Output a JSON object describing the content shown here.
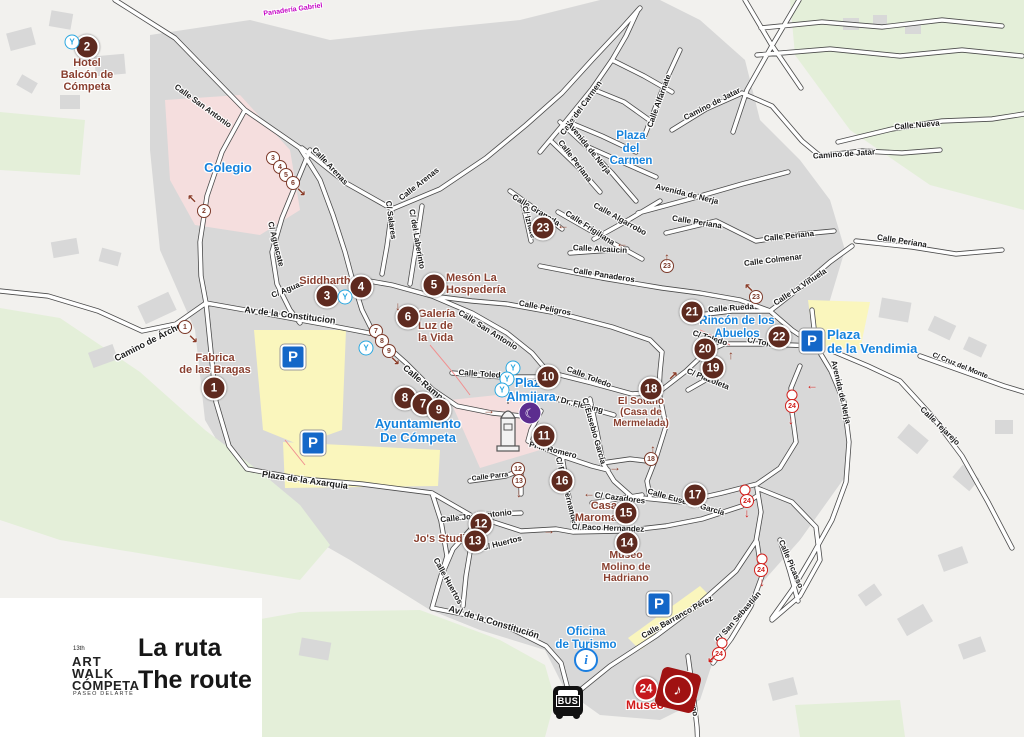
{
  "legend": {
    "edition": "13th",
    "logo_line1": "ART",
    "logo_line2": "WALK",
    "logo_line3": "CÓMPETA",
    "logo_subtitle": "PASEO DELARTE",
    "title_es": "La ruta",
    "title_en": "The route"
  },
  "colors": {
    "marker_brown": "#5e2a1f",
    "marker_red": "#c6181d",
    "route_brown": "#7c3a2a",
    "route_red": "#d1201c",
    "poi_maroon": "#8a4030",
    "poi_blue": "#1583dd",
    "parking_blue": "#1467c8",
    "museum_red": "#a01212",
    "moon_purple": "#5c2d8f",
    "parking_yellow": "#faf6bd",
    "school_pink": "#f5dede",
    "park_green": "#e4efd9",
    "building_gray": "#d8d8d8"
  },
  "icons": {
    "parking_glyph": "P",
    "info_glyph": "i",
    "bus_label": "BUS",
    "moon_glyph": "☾",
    "music_glyph": "♪",
    "fountain_glyph": "Y"
  },
  "markers": [
    {
      "n": "1",
      "x": 214,
      "y": 388
    },
    {
      "n": "2",
      "x": 87,
      "y": 47
    },
    {
      "n": "3",
      "x": 327,
      "y": 296
    },
    {
      "n": "4",
      "x": 361,
      "y": 287
    },
    {
      "n": "5",
      "x": 434,
      "y": 285
    },
    {
      "n": "6",
      "x": 408,
      "y": 317
    },
    {
      "n": "8",
      "x": 405,
      "y": 398
    },
    {
      "n": "7",
      "x": 423,
      "y": 404
    },
    {
      "n": "9",
      "x": 439,
      "y": 410
    },
    {
      "n": "10",
      "x": 548,
      "y": 377
    },
    {
      "n": "11",
      "x": 544,
      "y": 436
    },
    {
      "n": "12",
      "x": 481,
      "y": 524
    },
    {
      "n": "13",
      "x": 475,
      "y": 541
    },
    {
      "n": "14",
      "x": 627,
      "y": 543
    },
    {
      "n": "15",
      "x": 626,
      "y": 513
    },
    {
      "n": "16",
      "x": 562,
      "y": 481
    },
    {
      "n": "17",
      "x": 695,
      "y": 495
    },
    {
      "n": "18",
      "x": 651,
      "y": 389
    },
    {
      "n": "19",
      "x": 713,
      "y": 368
    },
    {
      "n": "20",
      "x": 705,
      "y": 349
    },
    {
      "n": "21",
      "x": 692,
      "y": 312
    },
    {
      "n": "22",
      "x": 779,
      "y": 337
    },
    {
      "n": "23",
      "x": 543,
      "y": 228
    },
    {
      "n": "24",
      "x": 646,
      "y": 689,
      "red": true
    }
  ],
  "pois": [
    {
      "lines": [
        "Hotel",
        "Balcón de",
        "Cómpeta"
      ],
      "x": 87,
      "y": 57,
      "fs": 11
    },
    {
      "lines": [
        "Fabrica",
        "de las Bragas"
      ],
      "x": 215,
      "y": 352,
      "fs": 11
    },
    {
      "lines": [
        "Siddhartha"
      ],
      "x": 328,
      "y": 275,
      "fs": 11
    },
    {
      "lines": [
        "Mesón La",
        "Hospedería"
      ],
      "x": 446,
      "y": 272,
      "fs": 11,
      "align": "left"
    },
    {
      "lines": [
        "Galería",
        "Luz de",
        "la Vida"
      ],
      "x": 418,
      "y": 308,
      "fs": 11,
      "align": "left"
    },
    {
      "lines": [
        "El Sotano",
        "(Casa de",
        "Mermelada)"
      ],
      "x": 641,
      "y": 396,
      "fs": 10
    },
    {
      "lines": [
        "Casa",
        "Maroma"
      ],
      "x": 617,
      "y": 500,
      "fs": 11,
      "align": "right"
    },
    {
      "lines": [
        "Museo",
        "Molino de",
        "Hadriano"
      ],
      "x": 626,
      "y": 550,
      "fs": 10.5
    },
    {
      "lines": [
        "Jo's Studio"
      ],
      "x": 443,
      "y": 533,
      "fs": 11
    },
    {
      "lines": [
        "Museo"
      ],
      "x": 645,
      "y": 699,
      "fs": 12,
      "cls": "red"
    },
    {
      "lines": [
        "Colegio"
      ],
      "x": 228,
      "y": 161,
      "fs": 13,
      "cls": "blue"
    },
    {
      "lines": [
        "Plaza",
        "del",
        "Carmen"
      ],
      "x": 631,
      "y": 130,
      "fs": 11.5,
      "cls": "blue"
    },
    {
      "lines": [
        "Plaza",
        "Almijara"
      ],
      "x": 531,
      "y": 377,
      "fs": 12.5,
      "cls": "blue"
    },
    {
      "lines": [
        "Ayuntamiento",
        "De Cómpeta"
      ],
      "x": 418,
      "y": 417,
      "fs": 13,
      "cls": "blue"
    },
    {
      "lines": [
        "Rincón de los",
        "Abuelos"
      ],
      "x": 737,
      "y": 315,
      "fs": 11.5,
      "cls": "blue"
    },
    {
      "lines": [
        "Plaza",
        "de la Vendimia"
      ],
      "x": 827,
      "y": 328,
      "fs": 13,
      "cls": "blue",
      "align": "left"
    },
    {
      "lines": [
        "Oficina",
        "de Turismo"
      ],
      "x": 586,
      "y": 626,
      "fs": 11.5,
      "cls": "blue"
    }
  ],
  "streets": [
    {
      "t": "Calle San Antonio",
      "x": 203,
      "y": 106,
      "r": 36
    },
    {
      "t": "Calle Arenas",
      "x": 330,
      "y": 166,
      "r": 47
    },
    {
      "t": "Calle Arenas",
      "x": 419,
      "y": 184,
      "r": -38
    },
    {
      "t": "C/ Salares",
      "x": 391,
      "y": 220,
      "r": 82
    },
    {
      "t": "C/ del Laberinto",
      "x": 417,
      "y": 239,
      "r": 80
    },
    {
      "t": "C/ Aguacate",
      "x": 276,
      "y": 244,
      "r": 76
    },
    {
      "t": "C/ Aguacate",
      "x": 293,
      "y": 287,
      "r": -22
    },
    {
      "t": "Av de la Constitucion",
      "x": 290,
      "y": 315,
      "r": 7,
      "fs": 9
    },
    {
      "t": "Camino de Árchez",
      "x": 150,
      "y": 341,
      "r": -27,
      "fs": 9
    },
    {
      "t": "Plaza de la Axarquia",
      "x": 305,
      "y": 480,
      "r": 8,
      "fs": 9
    },
    {
      "t": "Calle Rampa",
      "x": 425,
      "y": 384,
      "r": 40,
      "fs": 9
    },
    {
      "t": "Calle San Antonio",
      "x": 488,
      "y": 330,
      "r": 32
    },
    {
      "t": "Calle Peligros",
      "x": 545,
      "y": 308,
      "r": 11
    },
    {
      "t": "Calle Panaderos",
      "x": 604,
      "y": 275,
      "r": 9
    },
    {
      "t": "Calle Alcaucin",
      "x": 600,
      "y": 249,
      "r": 3
    },
    {
      "t": "Calle Frigiliana",
      "x": 590,
      "y": 228,
      "r": 33
    },
    {
      "t": "Calle Granada",
      "x": 536,
      "y": 210,
      "r": 31
    },
    {
      "t": "C/ Iznate",
      "x": 529,
      "y": 222,
      "r": 74
    },
    {
      "t": "Calle Algarrobo",
      "x": 620,
      "y": 219,
      "r": 29
    },
    {
      "t": "Calle del Carmen",
      "x": 581,
      "y": 108,
      "r": -54
    },
    {
      "t": "Calle Alfarnate",
      "x": 659,
      "y": 101,
      "r": -70
    },
    {
      "t": "Camino de Jatar",
      "x": 712,
      "y": 104,
      "r": -27
    },
    {
      "t": "Avenida de Nerja",
      "x": 589,
      "y": 148,
      "r": 51
    },
    {
      "t": "Calle Periana",
      "x": 575,
      "y": 161,
      "r": 53
    },
    {
      "t": "Avenida de Nerja",
      "x": 687,
      "y": 194,
      "r": 14
    },
    {
      "t": "Calle Periana",
      "x": 697,
      "y": 222,
      "r": 9
    },
    {
      "t": "Calle Periana",
      "x": 789,
      "y": 236,
      "r": -6
    },
    {
      "t": "Calle Periana",
      "x": 902,
      "y": 241,
      "r": 9
    },
    {
      "t": "Calle Nueva",
      "x": 917,
      "y": 125,
      "r": -5
    },
    {
      "t": "Camino de Jatar",
      "x": 844,
      "y": 154,
      "r": -4
    },
    {
      "t": "Calle Colmenar",
      "x": 773,
      "y": 260,
      "r": -7
    },
    {
      "t": "Calle La Viñuela",
      "x": 800,
      "y": 287,
      "r": -33
    },
    {
      "t": "Calle Rueda",
      "x": 731,
      "y": 308,
      "r": -4
    },
    {
      "t": "C/ Toledo",
      "x": 710,
      "y": 338,
      "r": 17
    },
    {
      "t": "C/ Toledo",
      "x": 765,
      "y": 343,
      "r": 11
    },
    {
      "t": "C/ Plazoleta",
      "x": 708,
      "y": 379,
      "r": 22
    },
    {
      "t": "Calle Toledo",
      "x": 482,
      "y": 374,
      "r": 4
    },
    {
      "t": "Calle Toledo",
      "x": 589,
      "y": 377,
      "r": 21
    },
    {
      "t": "C/ Dr. Fleming",
      "x": 577,
      "y": 404,
      "r": 14
    },
    {
      "t": "C/ Eusebio García",
      "x": 594,
      "y": 431,
      "r": 74
    },
    {
      "t": "Calle Eusebio García",
      "x": 686,
      "y": 502,
      "r": 16
    },
    {
      "t": "Pl P. Romero",
      "x": 553,
      "y": 450,
      "r": 14
    },
    {
      "t": "Calle Parra",
      "x": 490,
      "y": 477,
      "r": -7,
      "fs": 7
    },
    {
      "t": "C/ Paco Hernandez",
      "x": 567,
      "y": 492,
      "r": 76
    },
    {
      "t": "C/ Cazadores",
      "x": 620,
      "y": 498,
      "r": 7
    },
    {
      "t": "C/ Paco Hernandez",
      "x": 608,
      "y": 528,
      "r": 2
    },
    {
      "t": "Calle José Antonio",
      "x": 476,
      "y": 516,
      "r": -6
    },
    {
      "t": "C/ Huertos",
      "x": 502,
      "y": 543,
      "r": -14
    },
    {
      "t": "Calle Huertos",
      "x": 448,
      "y": 581,
      "r": 61
    },
    {
      "t": "Av/ de la Constitución",
      "x": 494,
      "y": 622,
      "r": 17,
      "fs": 9
    },
    {
      "t": "Calle Barranco Pérez",
      "x": 677,
      "y": 617,
      "r": -29
    },
    {
      "t": "Calle Horno",
      "x": 691,
      "y": 694,
      "r": 78
    },
    {
      "t": "C/ San Sebastián",
      "x": 738,
      "y": 617,
      "r": -49
    },
    {
      "t": "Calle Picasso",
      "x": 791,
      "y": 564,
      "r": 67
    },
    {
      "t": "Avenida de Nerja",
      "x": 841,
      "y": 392,
      "r": 77
    },
    {
      "t": "C/ Cruz del Monte",
      "x": 960,
      "y": 366,
      "r": 22,
      "fs": 7
    },
    {
      "t": "Calle Tejarejo",
      "x": 940,
      "y": 426,
      "r": 44
    },
    {
      "t": "Panadería Gabriel",
      "x": 293,
      "y": 10,
      "r": -8,
      "cls": "magenta",
      "fs": 7
    }
  ],
  "route_badges": [
    {
      "n": "1",
      "x": 185,
      "y": 327
    },
    {
      "n": "2",
      "x": 204,
      "y": 211
    },
    {
      "n": "3",
      "x": 273,
      "y": 158
    },
    {
      "n": "4",
      "x": 280,
      "y": 167
    },
    {
      "n": "5",
      "x": 286,
      "y": 175
    },
    {
      "n": "6",
      "x": 293,
      "y": 183
    },
    {
      "n": "7",
      "x": 376,
      "y": 331
    },
    {
      "n": "8",
      "x": 382,
      "y": 341
    },
    {
      "n": "9",
      "x": 389,
      "y": 351
    },
    {
      "n": "12",
      "x": 518,
      "y": 469
    },
    {
      "n": "13",
      "x": 519,
      "y": 481
    },
    {
      "n": "18",
      "x": 651,
      "y": 459
    },
    {
      "n": "23",
      "x": 667,
      "y": 266
    },
    {
      "n": "23",
      "x": 756,
      "y": 297
    },
    {
      "n": "",
      "x": 792,
      "y": 395,
      "red": true
    },
    {
      "n": "24",
      "x": 792,
      "y": 406,
      "red": true
    },
    {
      "n": "",
      "x": 745,
      "y": 490,
      "red": true
    },
    {
      "n": "24",
      "x": 747,
      "y": 501,
      "red": true
    },
    {
      "n": "",
      "x": 762,
      "y": 559,
      "red": true
    },
    {
      "n": "24",
      "x": 761,
      "y": 570,
      "red": true
    },
    {
      "n": "",
      "x": 722,
      "y": 643,
      "red": true
    },
    {
      "n": "24",
      "x": 719,
      "y": 654,
      "red": true
    }
  ],
  "arrows": [
    {
      "g": "↖",
      "x": 192,
      "y": 199
    },
    {
      "g": "↘",
      "x": 193,
      "y": 339
    },
    {
      "g": "↘",
      "x": 301,
      "y": 192
    },
    {
      "g": "↓",
      "x": 398,
      "y": 306
    },
    {
      "g": "↘",
      "x": 395,
      "y": 361
    },
    {
      "g": "→",
      "x": 489,
      "y": 410
    },
    {
      "g": "→",
      "x": 615,
      "y": 467
    },
    {
      "g": "↓",
      "x": 519,
      "y": 493
    },
    {
      "g": "→",
      "x": 549,
      "y": 530
    },
    {
      "g": "←",
      "x": 589,
      "y": 493
    },
    {
      "g": "↑",
      "x": 653,
      "y": 449
    },
    {
      "g": "↗",
      "x": 673,
      "y": 376
    },
    {
      "g": "↑",
      "x": 731,
      "y": 355
    },
    {
      "g": "←",
      "x": 563,
      "y": 225
    },
    {
      "g": "←",
      "x": 622,
      "y": 243
    },
    {
      "g": "↑",
      "x": 667,
      "y": 257
    },
    {
      "g": "↖",
      "x": 749,
      "y": 288
    },
    {
      "g": "←",
      "x": 812,
      "y": 385,
      "red": true
    },
    {
      "g": "↓",
      "x": 791,
      "y": 420,
      "red": true
    },
    {
      "g": "↓",
      "x": 747,
      "y": 513,
      "red": true
    },
    {
      "g": "↓",
      "x": 762,
      "y": 582,
      "red": true
    },
    {
      "g": "↙",
      "x": 712,
      "y": 659,
      "red": true
    }
  ],
  "fountains": [
    [
      72,
      42
    ],
    [
      345,
      297
    ],
    [
      366,
      348
    ],
    [
      513,
      368
    ],
    [
      507,
      379
    ],
    [
      502,
      390
    ]
  ],
  "parking": [
    [
      293,
      357
    ],
    [
      313,
      443
    ],
    [
      812,
      341
    ],
    [
      659,
      604
    ]
  ],
  "info_office": {
    "x": 586,
    "y": 660
  },
  "bus_stop": {
    "x": 568,
    "y": 701
  },
  "moon_badge": {
    "x": 530,
    "y": 413
  },
  "museum_icon": {
    "x": 678,
    "y": 690
  }
}
